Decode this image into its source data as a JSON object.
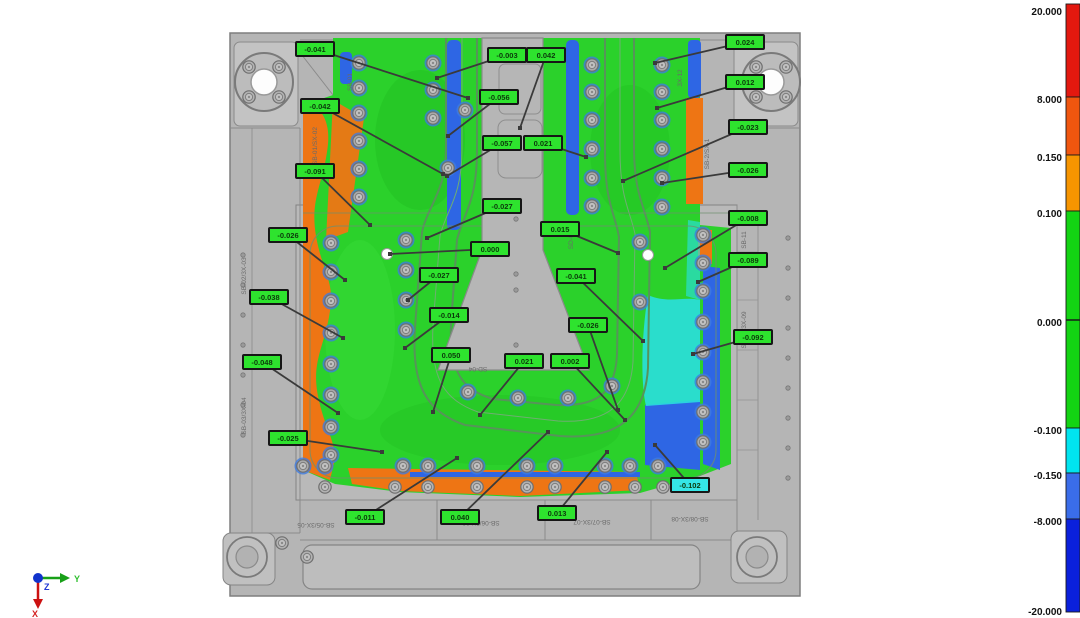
{
  "colors": {
    "field_green": "#2bd12b",
    "field_orange": "#ee7514",
    "field_blue": "#2e66e4",
    "field_cyan": "#2adede",
    "label_green": "#2ee32e",
    "label_cyan": "#35e6e6",
    "label_border": "#161616",
    "label_text": "#0b3a0b",
    "leader": "#3a3a3a",
    "plate": "#b5b5b5"
  },
  "scale": {
    "bar_x": 1066,
    "bar_w": 14,
    "top": 4,
    "bottom": 612,
    "zero_tick_y": 320,
    "segments": [
      {
        "name": "red",
        "color": "#e3180f",
        "from": 4,
        "to": 97
      },
      {
        "name": "orange-red",
        "color": "#f0560f",
        "from": 97,
        "to": 155
      },
      {
        "name": "orange",
        "color": "#f79500",
        "from": 155,
        "to": 211
      },
      {
        "name": "green",
        "color": "#13d413",
        "from": 211,
        "to": 428
      },
      {
        "name": "cyan",
        "color": "#00e4ef",
        "from": 428,
        "to": 473
      },
      {
        "name": "mid-blue",
        "color": "#3a6de9",
        "from": 473,
        "to": 519
      },
      {
        "name": "deep-blue",
        "color": "#0a20dc",
        "from": 519,
        "to": 612
      }
    ],
    "ticks": [
      {
        "value": "20.000",
        "y": 12
      },
      {
        "value": "8.000",
        "y": 100
      },
      {
        "value": "0.150",
        "y": 158
      },
      {
        "value": "0.100",
        "y": 214
      },
      {
        "value": "0.000",
        "y": 323
      },
      {
        "value": "-0.100",
        "y": 431
      },
      {
        "value": "-0.150",
        "y": 476
      },
      {
        "value": "-8.000",
        "y": 522
      },
      {
        "value": "-20.000",
        "y": 612
      }
    ]
  },
  "annotations": [
    {
      "value": "-0.041",
      "x": 315,
      "y": 49,
      "tx": 468,
      "ty": 98,
      "type": "green"
    },
    {
      "value": "-0.003",
      "x": 507,
      "y": 55,
      "tx": 437,
      "ty": 78,
      "type": "green"
    },
    {
      "value": "0.042",
      "x": 546,
      "y": 55,
      "tx": 520,
      "ty": 128,
      "type": "green"
    },
    {
      "value": "0.024",
      "x": 745,
      "y": 42,
      "tx": 655,
      "ty": 63,
      "type": "green"
    },
    {
      "value": "-0.042",
      "x": 320,
      "y": 106,
      "tx": 443,
      "ty": 174,
      "type": "green"
    },
    {
      "value": "-0.056",
      "x": 499,
      "y": 97,
      "tx": 448,
      "ty": 136,
      "type": "green"
    },
    {
      "value": "0.012",
      "x": 745,
      "y": 82,
      "tx": 657,
      "ty": 108,
      "type": "green"
    },
    {
      "value": "-0.023",
      "x": 748,
      "y": 127,
      "tx": 623,
      "ty": 181,
      "type": "green"
    },
    {
      "value": "-0.057",
      "x": 502,
      "y": 143,
      "tx": 447,
      "ty": 176,
      "type": "green"
    },
    {
      "value": "0.021",
      "x": 543,
      "y": 143,
      "tx": 586,
      "ty": 157,
      "type": "green"
    },
    {
      "value": "-0.026",
      "x": 748,
      "y": 170,
      "tx": 662,
      "ty": 183,
      "type": "green"
    },
    {
      "value": "-0.091",
      "x": 315,
      "y": 171,
      "tx": 370,
      "ty": 225,
      "type": "green"
    },
    {
      "value": "-0.027",
      "x": 502,
      "y": 206,
      "tx": 427,
      "ty": 238,
      "type": "green"
    },
    {
      "value": "0.015",
      "x": 560,
      "y": 229,
      "tx": 618,
      "ty": 253,
      "type": "green"
    },
    {
      "value": "-0.008",
      "x": 748,
      "y": 218,
      "tx": 665,
      "ty": 268,
      "type": "green"
    },
    {
      "value": "0.000",
      "x": 490,
      "y": 249,
      "tx": 390,
      "ty": 254,
      "type": "green"
    },
    {
      "value": "-0.026",
      "x": 288,
      "y": 235,
      "tx": 345,
      "ty": 280,
      "type": "green"
    },
    {
      "value": "-0.027",
      "x": 439,
      "y": 275,
      "tx": 408,
      "ty": 300,
      "type": "green"
    },
    {
      "value": "-0.041",
      "x": 576,
      "y": 276,
      "tx": 643,
      "ty": 341,
      "type": "green"
    },
    {
      "value": "-0.089",
      "x": 748,
      "y": 260,
      "tx": 698,
      "ty": 282,
      "type": "green"
    },
    {
      "value": "-0.038",
      "x": 269,
      "y": 297,
      "tx": 343,
      "ty": 338,
      "type": "green"
    },
    {
      "value": "-0.014",
      "x": 449,
      "y": 315,
      "tx": 405,
      "ty": 348,
      "type": "green"
    },
    {
      "value": "-0.026",
      "x": 588,
      "y": 325,
      "tx": 618,
      "ty": 410,
      "type": "green"
    },
    {
      "value": "-0.092",
      "x": 753,
      "y": 337,
      "tx": 693,
      "ty": 354,
      "type": "green"
    },
    {
      "value": "0.050",
      "x": 451,
      "y": 355,
      "tx": 433,
      "ty": 412,
      "type": "green"
    },
    {
      "value": "0.021",
      "x": 524,
      "y": 361,
      "tx": 480,
      "ty": 415,
      "type": "green"
    },
    {
      "value": "0.002",
      "x": 570,
      "y": 361,
      "tx": 625,
      "ty": 420,
      "type": "green"
    },
    {
      "value": "-0.048",
      "x": 262,
      "y": 362,
      "tx": 338,
      "ty": 413,
      "type": "green"
    },
    {
      "value": "-0.025",
      "x": 288,
      "y": 438,
      "tx": 382,
      "ty": 452,
      "type": "green"
    },
    {
      "value": "-0.011",
      "x": 365,
      "y": 517,
      "tx": 457,
      "ty": 458,
      "type": "green"
    },
    {
      "value": "0.040",
      "x": 460,
      "y": 517,
      "tx": 548,
      "ty": 432,
      "type": "green"
    },
    {
      "value": "0.013",
      "x": 557,
      "y": 513,
      "tx": 607,
      "ty": 452,
      "type": "green"
    },
    {
      "value": "-0.102",
      "x": 690,
      "y": 485,
      "tx": 655,
      "ty": 445,
      "type": "cyan"
    }
  ],
  "region_ids": [
    {
      "text": "SB-01",
      "x": 352,
      "y": 82,
      "rot": -90
    },
    {
      "text": "SB-01/SX-02",
      "x": 317,
      "y": 146,
      "rot": -90
    },
    {
      "text": "SB-02/3X-03",
      "x": 246,
      "y": 276,
      "rot": -90
    },
    {
      "text": "SB-03/3X-04",
      "x": 246,
      "y": 416,
      "rot": -90
    },
    {
      "text": "3X-12",
      "x": 682,
      "y": 78,
      "rot": -90
    },
    {
      "text": "SB-2/SX-1",
      "x": 709,
      "y": 154,
      "rot": -90
    },
    {
      "text": "SB-11",
      "x": 746,
      "y": 240,
      "rot": -90
    },
    {
      "text": "SB-10/3X-09",
      "x": 746,
      "y": 330,
      "rot": -90
    },
    {
      "text": "SD-07",
      "x": 573,
      "y": 240,
      "rot": -90
    },
    {
      "text": "SD-04",
      "x": 478,
      "y": 367,
      "rot": 180
    },
    {
      "text": "SB-05/3X-05",
      "x": 316,
      "y": 523,
      "rot": 180
    },
    {
      "text": "SB-06/3X-06",
      "x": 481,
      "y": 521,
      "rot": 180
    },
    {
      "text": "SB-07/3X-07",
      "x": 592,
      "y": 520,
      "rot": 180
    },
    {
      "text": "SB-08/3X-08",
      "x": 690,
      "y": 517,
      "rot": 180
    }
  ],
  "triad": {
    "x_label": "X",
    "y_label": "Y",
    "z_label": "Z",
    "x_color": "#d42020",
    "y_color": "#2fbf2f",
    "z_color": "#2038d4"
  },
  "hardware": {
    "field_screws": [
      [
        359,
        63
      ],
      [
        359,
        88
      ],
      [
        359,
        113
      ],
      [
        359,
        141
      ],
      [
        359,
        169
      ],
      [
        359,
        197
      ],
      [
        433,
        63
      ],
      [
        433,
        90
      ],
      [
        433,
        118
      ],
      [
        465,
        110
      ],
      [
        448,
        168
      ],
      [
        592,
        65
      ],
      [
        592,
        92
      ],
      [
        592,
        120
      ],
      [
        592,
        149
      ],
      [
        592,
        178
      ],
      [
        592,
        206
      ],
      [
        662,
        65
      ],
      [
        662,
        92
      ],
      [
        662,
        120
      ],
      [
        662,
        149
      ],
      [
        662,
        178
      ],
      [
        662,
        207
      ],
      [
        331,
        243
      ],
      [
        331,
        272
      ],
      [
        331,
        301
      ],
      [
        331,
        333
      ],
      [
        331,
        364
      ],
      [
        331,
        395
      ],
      [
        331,
        427
      ],
      [
        331,
        455
      ],
      [
        703,
        235
      ],
      [
        703,
        263
      ],
      [
        703,
        291
      ],
      [
        703,
        322
      ],
      [
        703,
        352
      ],
      [
        703,
        382
      ],
      [
        703,
        412
      ],
      [
        703,
        442
      ],
      [
        406,
        240
      ],
      [
        406,
        270
      ],
      [
        406,
        300
      ],
      [
        406,
        330
      ],
      [
        640,
        242
      ],
      [
        640,
        302
      ],
      [
        468,
        392
      ],
      [
        518,
        398
      ],
      [
        568,
        398
      ],
      [
        612,
        386
      ],
      [
        303,
        466
      ],
      [
        325,
        466
      ],
      [
        403,
        466
      ],
      [
        428,
        466
      ],
      [
        477,
        466
      ],
      [
        527,
        466
      ],
      [
        555,
        466
      ],
      [
        605,
        466
      ],
      [
        630,
        466
      ],
      [
        658,
        466
      ]
    ],
    "plate_screws": [
      [
        325,
        487
      ],
      [
        395,
        487
      ],
      [
        428,
        487
      ],
      [
        477,
        487
      ],
      [
        527,
        487
      ],
      [
        555,
        487
      ],
      [
        605,
        487
      ],
      [
        635,
        487
      ],
      [
        663,
        487
      ],
      [
        249,
        67
      ],
      [
        279,
        67
      ],
      [
        249,
        97
      ],
      [
        279,
        97
      ],
      [
        756,
        67
      ],
      [
        786,
        67
      ],
      [
        756,
        97
      ],
      [
        786,
        97
      ],
      [
        282,
        543
      ],
      [
        307,
        557
      ]
    ],
    "small_holes": [
      [
        243,
        255
      ],
      [
        243,
        285
      ],
      [
        243,
        315
      ],
      [
        243,
        345
      ],
      [
        243,
        375
      ],
      [
        243,
        405
      ],
      [
        243,
        435
      ],
      [
        788,
        238
      ],
      [
        788,
        268
      ],
      [
        788,
        298
      ],
      [
        788,
        328
      ],
      [
        788,
        358
      ],
      [
        788,
        388
      ],
      [
        788,
        418
      ],
      [
        788,
        448
      ],
      [
        788,
        478
      ],
      [
        516,
        219
      ],
      [
        516,
        274
      ],
      [
        516,
        290
      ],
      [
        516,
        345
      ]
    ],
    "reference_spheres": [
      [
        387,
        254
      ],
      [
        648,
        255
      ]
    ]
  }
}
